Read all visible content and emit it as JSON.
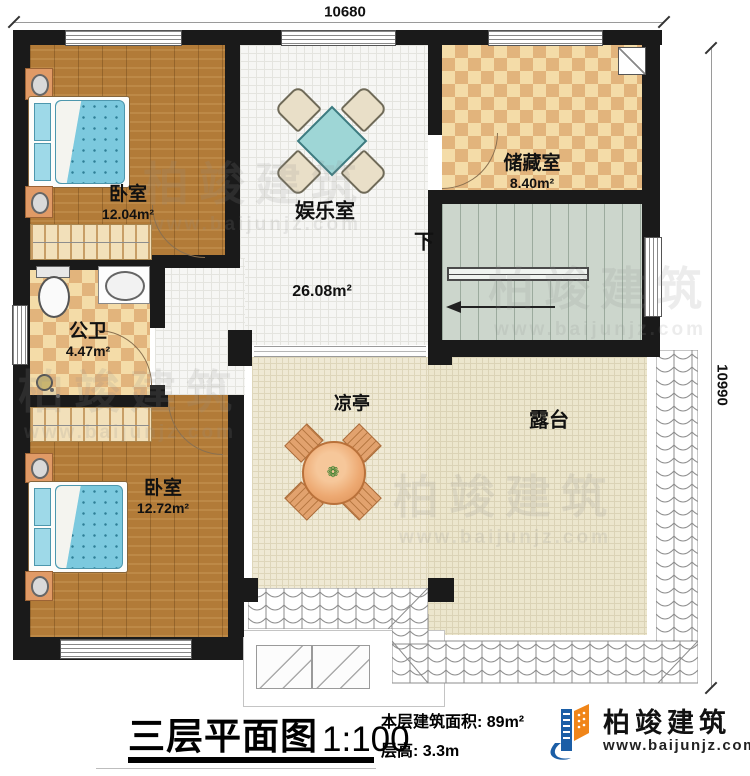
{
  "plan": {
    "dimensions": {
      "top": "10680",
      "right": "10990"
    },
    "rooms": [
      {
        "name": "卧室",
        "area": "12.04m²"
      },
      {
        "name": "娱乐室",
        "area": "26.08m²"
      },
      {
        "name": "储藏室",
        "area": "8.40m²"
      },
      {
        "name": "公卫",
        "area": "4.47m²"
      },
      {
        "name": "卧室",
        "area": "12.72m²"
      },
      {
        "name": "凉亭"
      },
      {
        "name": "露台"
      }
    ],
    "stairs_down_label": "下"
  },
  "titleblock": {
    "title": "三层平面图",
    "scale": "1:100",
    "area_line": "本层建筑面积: 89m²",
    "height_line": "层高: 3.3m"
  },
  "brand": {
    "name": "柏竣建筑",
    "website": "www.baijunjz.com"
  },
  "watermark": {
    "name": "柏竣建筑",
    "website": "www.baijunjz.com"
  }
}
